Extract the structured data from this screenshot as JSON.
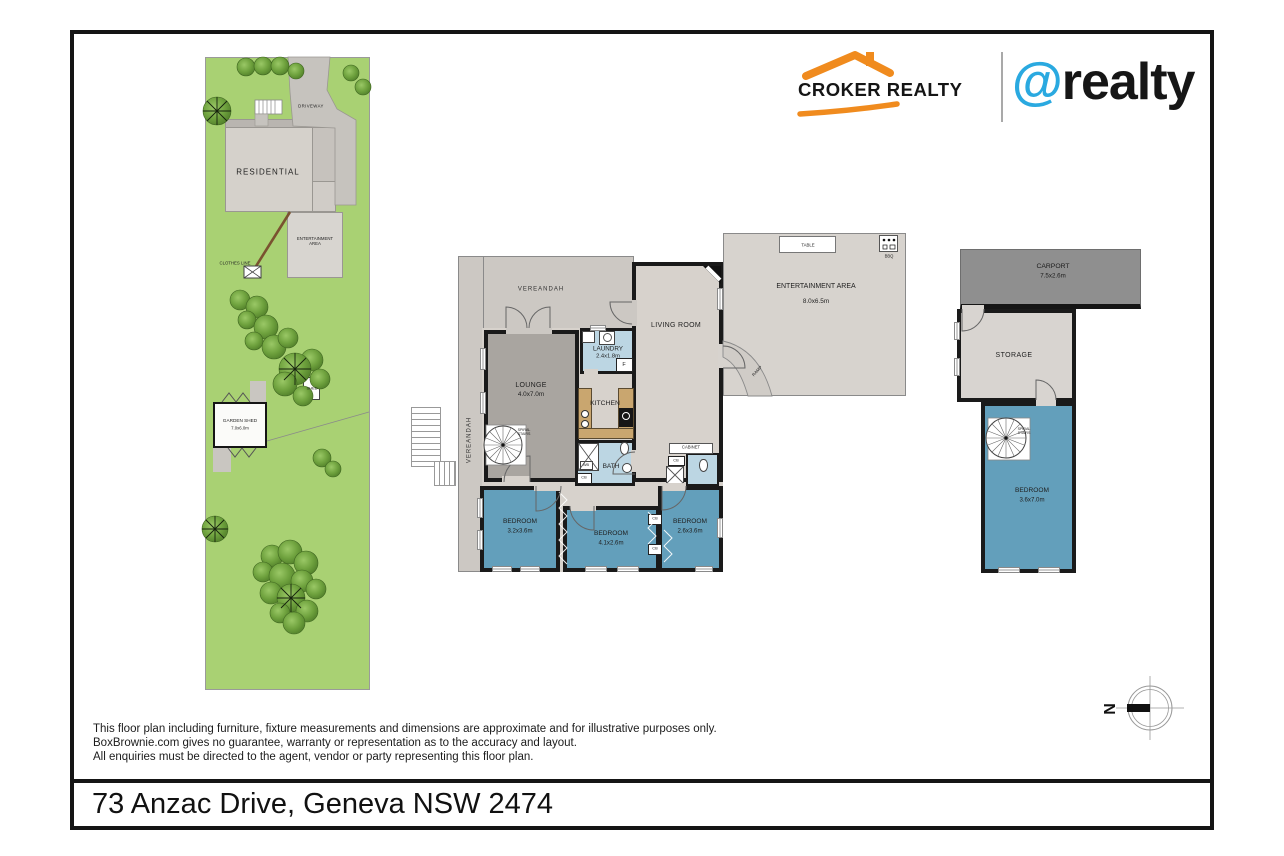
{
  "brand": {
    "croker": "CROKER REALTY",
    "at": "@",
    "realty": "realty"
  },
  "site": {
    "driveway": "DRIVEWAY",
    "residential": "RESIDENTIAL",
    "entertainment_area": "ENTERTAINMENT AREA",
    "clothes_line": "CLOTHES LINE",
    "shed": "SHED",
    "garden_shed": "GARDEN SHED",
    "garden_shed_dims": "7.0x6.0m"
  },
  "plan": {
    "verandah_top": "VEREANDAH",
    "verandah_left": "VEREANDAH",
    "lounge": "LOUNGE",
    "lounge_dims": "4.0x7.0m",
    "laundry": "LAUNDRY",
    "laundry_dims": "2.4x1.8m",
    "living_room": "LIVING ROOM",
    "kitchen": "KITCHEN",
    "bath": "BATH",
    "fridge": "F",
    "wash_basin": "WB",
    "cupboard": "CB",
    "cabinet": "CABINET",
    "spiral_stairs": "SPIRAL STAIRS",
    "bedroom1": "BEDROOM",
    "bedroom1_dims": "3.2x3.6m",
    "bedroom2": "BEDROOM",
    "bedroom2_dims": "4.1x2.6m",
    "bedroom3": "BEDROOM",
    "bedroom3_dims": "2.6x3.6m",
    "entertainment": "ENTERTAINMENT AREA",
    "entertainment_dims": "8.0x6.5m",
    "table": "TABLE",
    "bbq": "BBQ",
    "ramp": "RAMP"
  },
  "wing": {
    "carport": "CARPORT",
    "carport_dims": "7.5x2.6m",
    "storage": "STORAGE",
    "bedroom": "BEDROOM",
    "bedroom_dims": "3.6x7.0m",
    "spiral_stairs": "SPIRAL STAIRS"
  },
  "compass": {
    "north": "N"
  },
  "footer": {
    "disclaimer": [
      "This floor plan including furniture, fixture measurements and dimensions are approximate and for illustrative purposes only.",
      "BoxBrownie.com gives no guarantee, warranty or representation as to the accuracy and layout.",
      "All enquiries must be directed to the agent, vendor or party representing this floor plan."
    ],
    "address": "73 Anzac Drive, Geneva NSW 2474"
  },
  "colors": {
    "accent_orange": "#f08b1e",
    "accent_blue": "#2aa9e0",
    "grass_green": "#a9d173",
    "bedroom_blue": "#639fbb",
    "wet_area_blue": "#bcd6e3",
    "verandah_grey": "#ccc8c3",
    "lounge_grey": "#a9a5a0",
    "interior_beige": "#d7d2cc",
    "carport_grey": "#8f8f8f",
    "counter_tan": "#c9a66f"
  }
}
